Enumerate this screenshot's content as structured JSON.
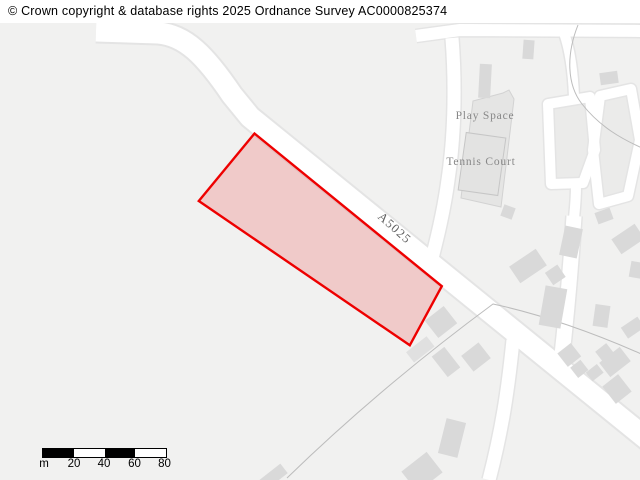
{
  "banner": {
    "copyright": "© Crown copyright & database rights 2025 Ordnance Survey AC0000825374"
  },
  "map": {
    "road_label": "A5025",
    "labels": {
      "play_space": "Play Space",
      "tennis_court": "Tennis Court"
    },
    "highlight": {
      "stroke": "#ee0000",
      "fill": "rgba(238,0,0,0.16)"
    },
    "colors": {
      "background": "#f1f1f0",
      "road": "#ffffff",
      "road_casing": "#e4e4e4",
      "building": "#d9d9d9",
      "boundary_line": "#bcbcbc",
      "label_text": "#878787"
    }
  },
  "scalebar": {
    "unit": "m",
    "ticks": [
      "20",
      "40",
      "60",
      "80"
    ]
  }
}
